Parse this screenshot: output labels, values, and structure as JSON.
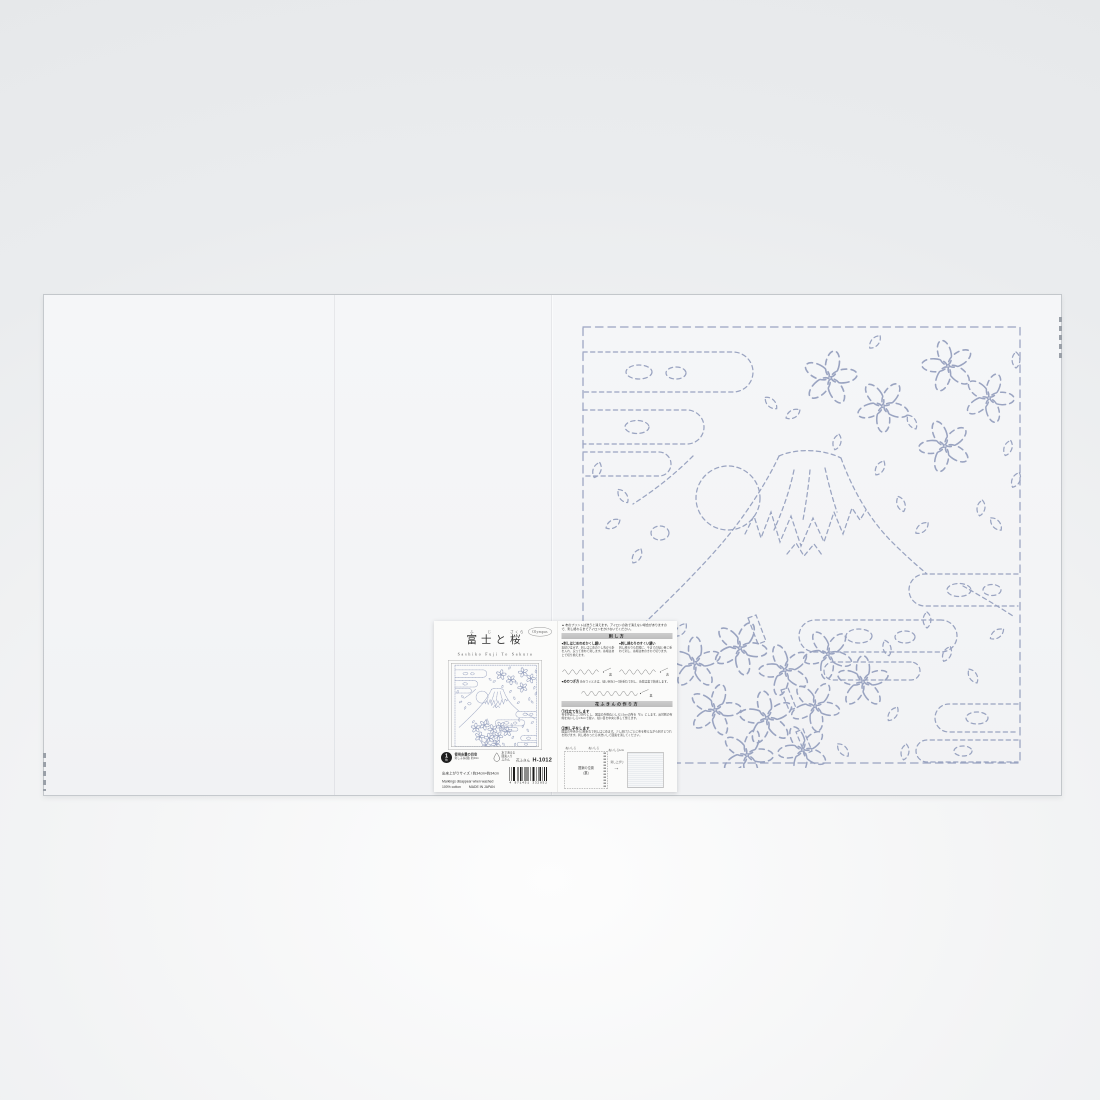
{
  "colors": {
    "pattern_line": "#9aa4c1",
    "backdrop": "#eceeef",
    "fabric": "#f4f5f7",
    "section_bar": "#c4c4c4"
  },
  "label": {
    "brand": "Olympus",
    "title_fuji": "富士",
    "furigana_fuji": "ふじ",
    "title_to": "と",
    "title_sakura": "桜",
    "furigana_sakura": "さくら",
    "subtitle": "Sashiko Fuji To Sakura",
    "usage": {
      "badge_number": "1",
      "badge_unit": "枚",
      "title": "使用糸量の目安",
      "detail": "刺し子糸(細) 約40m"
    },
    "washable": {
      "line1": "水で消える",
      "line2": "図案入り",
      "line3": "ふきん"
    },
    "product_type": "花ふきん",
    "product_code": "H-1012",
    "size_line": "出来上がりサイズ / 約34cm×約34cm",
    "english_line1": "Markings disappear when washed",
    "english_cotton": "100% cotton",
    "made_in": "MADE IN JAPAN",
    "barcode_number": "4 971451 332052",
    "instructions": {
      "warning": "▲ 布のプリントは洗うと消えます。アイロンの熱で消えない場合がありますので、刺し終わるまでアイロンをかけないでください。",
      "stitch_section": {
        "title": "刺し方",
        "start_title": "●刺しはじめのめかくし繕い",
        "start_body": "玉結びはせず、刺しはじめの少し先から針を入れ、戻って重ねて刺します。糸端はあとで切り揃えます。",
        "end_title": "●刺し終わりのすくい繕い",
        "end_body": "刺し終わりも同様に、今までの縫い目に重ねて刺し、糸端は布のきわで切ります。",
        "join_title": "●めのつぎ方",
        "join_body": "糸をつぐときは、縫い目を2〜3針重ねて刺し、糸端は裏で始末します。",
        "label_front": "表",
        "label_back": "裏"
      },
      "make_section": {
        "title": "花ふきんの作り方",
        "step1_title": "①仕立てをします",
        "step1_body": "布を外表に二つ折りにし、図案の外側ぬいしろ1.5cmの所を「わ」にします。反対側の布端をぬいしろ1.5cmで縫い、縫い目を中央に移して整えます。",
        "step2_title": "②刺し子をします",
        "step2_body": "図案の中央から2枚重ねで刺しはじめます。少し刺けたごとに布を整えながら刺すとつれを防げます。刺し終わったら水洗いして図案を消してください。",
        "diagram_seam_left": "ぬいしろ",
        "diagram_seam_right": "ぬいしろ",
        "diagram_seam_note": "ぬいしろ1cm",
        "diagram_square_line1": "図案の位置",
        "diagram_square_line2": "(裏)",
        "diagram_arrow_label": "刺し上がり"
      }
    }
  }
}
